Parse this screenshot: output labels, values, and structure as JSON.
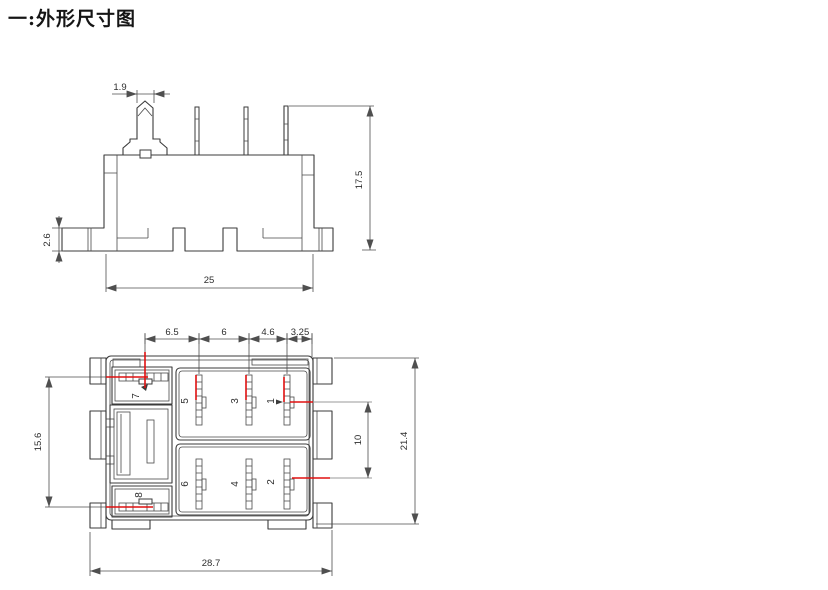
{
  "title": "一:外形尺寸图",
  "colors": {
    "line": "#3b3b3b",
    "dimension": "#4f4f4f",
    "highlight_red": "#e01010",
    "background": "#ffffff"
  },
  "front_view": {
    "dims": {
      "pin_width": "1.9",
      "overall_height": "17.5",
      "flange_height": "2.6",
      "base_width": "25"
    }
  },
  "bottom_view": {
    "dims": {
      "spacing_a": "6.5",
      "spacing_b": "6",
      "spacing_c": "4.6",
      "spacing_d": "3.25",
      "left_row_span": "15.6",
      "row_spacing": "10",
      "body_depth": "21.4",
      "overall_width": "28.7"
    },
    "pins": {
      "p1": "1",
      "p2": "2",
      "p3": "3",
      "p4": "4",
      "p5": "5",
      "p6": "6",
      "p7": "7",
      "p8": "8"
    }
  }
}
